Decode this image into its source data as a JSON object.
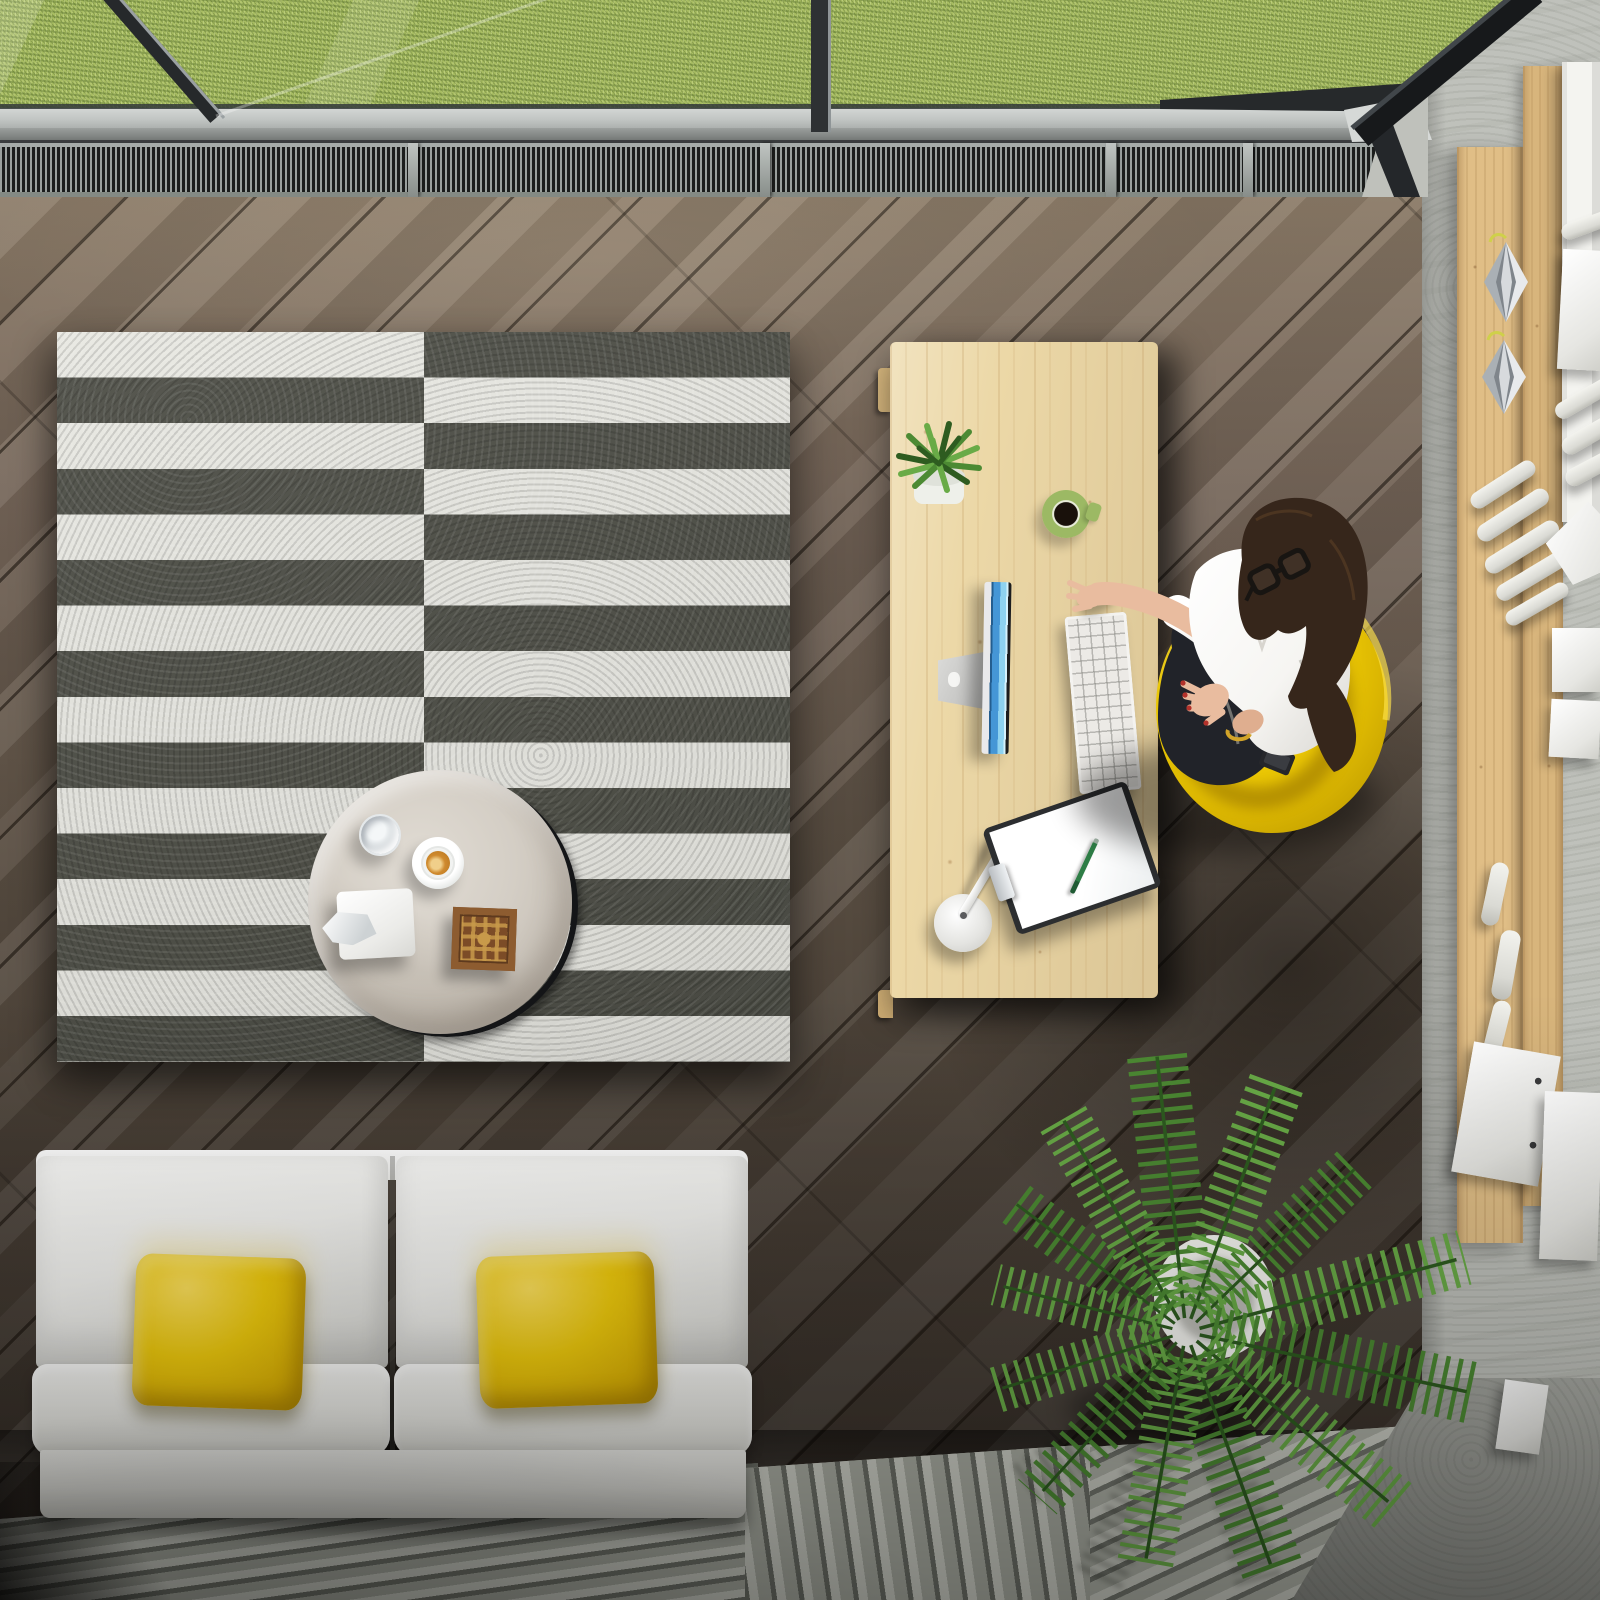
{
  "scene": {
    "title": "Top-down 3D rendering of a modern home office: woman in a yellow chair at a wooden desk, white sofa with yellow pillows, black-and-white striped rug with round coffee table, palm plant, wall shelf with paper rolls, and grass visible through a skylight window",
    "view": "overhead top view",
    "objects": [
      {
        "name": "skylight-window",
        "description": "glass panels with dark mullions, green lawn outside"
      },
      {
        "name": "ventilation-grille",
        "description": "dark slatted vent strip along window sill"
      },
      {
        "name": "hardwood-floor",
        "description": "dark gray-brown diagonal wood planks"
      },
      {
        "name": "striped-rug",
        "description": "two-panel rug with offset black and white horizontal stripes"
      },
      {
        "name": "coffee-table",
        "description": "round marble-top table on black tray ring with water glass, cappuccino, tissue box and carved wooden box"
      },
      {
        "name": "sofa",
        "description": "white two-seat sofa with two yellow cushions"
      },
      {
        "name": "desk",
        "description": "light pine desk with succulent, green mug of coffee, monitor, keyboard, mouse, lamp and clipboard with green pen"
      },
      {
        "name": "woman",
        "description": "dark-haired woman with glasses, white blouse and black skirt gesturing in a yellow tub chair"
      },
      {
        "name": "wall-shelf",
        "description": "vertical pine boards with white paper rolls, books and silver geometric ornaments"
      },
      {
        "name": "palm-plant",
        "description": "potted areca palm in white planter on slatted floor"
      },
      {
        "name": "slatted-floor",
        "description": "light gray slatted walkway along bottom edge"
      },
      {
        "name": "concrete-wall",
        "description": "light gray concrete wall on the right side"
      }
    ]
  },
  "palette": {
    "grass": "#a8bd62",
    "grassDark": "#7e9a4a",
    "grassLight": "#ccdb96",
    "frameDark": "#26292b",
    "frameLight": "#9aa0a2",
    "sillLight": "#d4d7d5",
    "sillMid": "#9b9f9d",
    "grooveDark": "#3c3f40",
    "grilleDark": "#1b1d1c",
    "grilleSlat": "#9aa09d",
    "railTop": "#a6aca9",
    "railBottom": "#848a84",
    "floorLight": "#8d7d6a",
    "floorMid": "#5e5347",
    "floorDark": "#362f29",
    "rugWhite": "#e8e8e2",
    "rugDark": "#4e4f47",
    "marbleLight": "#e1dcd4",
    "marbleDark": "#b5ada2",
    "trayRing": "#141517",
    "glassRim": "#c9cfd3",
    "coffeeFoam": "#f0cf8a",
    "coffeeBrown": "#cf8a2e",
    "woodBox": "#7c4c27",
    "woodBoxCarve": "#c89a4a",
    "sofaWhite": "#f4f4f1",
    "sofaShade": "#cfcfc9",
    "pillowYellow": "#f2cd0d",
    "pillowDeep": "#c29d04",
    "slatBase": "#b3b6ac",
    "slatLight": "#c6c8bf",
    "deskWood": "#ecd8a7",
    "mugGreen": "#9cb964",
    "mugCoffee": "#19110b",
    "bezel": "#e9e9eb",
    "monitorBlue": "#4596d6",
    "monitorBlueLight": "#8ed2f0",
    "keyWhite": "#eceae6",
    "clipboardDark": "#2c2e30",
    "paperWhite": "#ffffff",
    "penGreen": "#2e7d46",
    "chairYellow": "#f2cf06",
    "chairShade": "#c9a403",
    "chairHighlight": "#ffe34d",
    "skin": "#e9bc9f",
    "hairBrown": "#36261b",
    "blouse": "#f6f5f2",
    "pants": "#212329",
    "nailRed": "#b3322b",
    "braceletGold": "#d2a429",
    "lipRose": "#b06a5a",
    "palmGreen": "#4c8a33",
    "palmLight": "#69ab47",
    "palmDark": "#2e5c20",
    "potWhite": "#f4f4f0",
    "concrete": "#bfc1bb",
    "concreteDark": "#9fa19a",
    "shelfWood": "#e0be86",
    "tubeWhite": "#f3f3ee",
    "silverLight": "#e8eaec",
    "silverMid": "#aab0b5",
    "silverDark": "#7f858b"
  }
}
